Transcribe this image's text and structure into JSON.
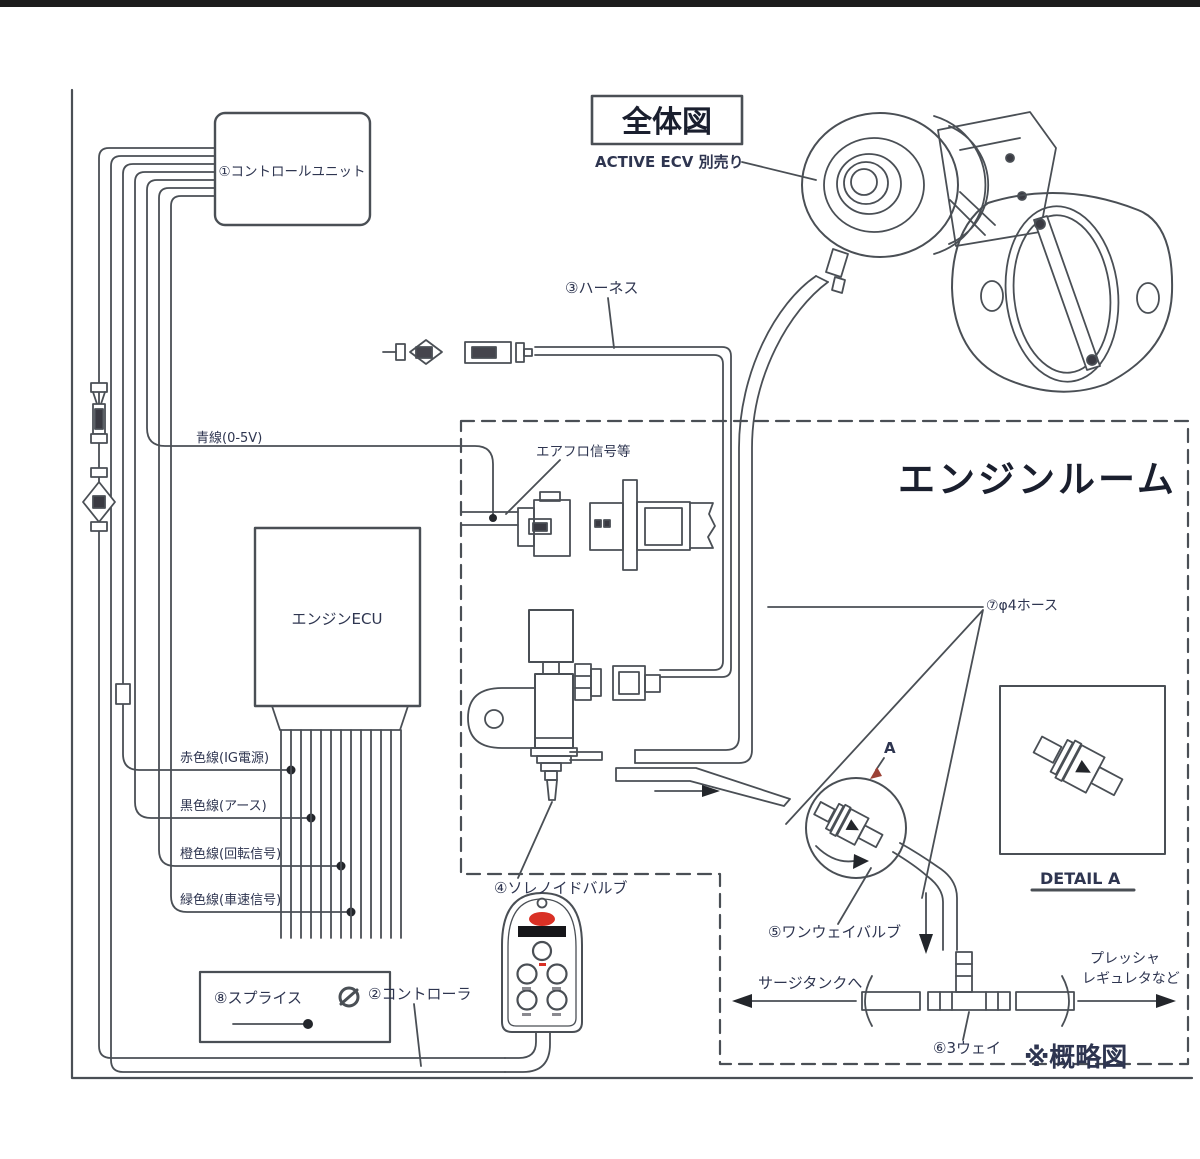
{
  "diagram": {
    "title": "全体図",
    "subtitle": "ACTIVE ECV 別売り",
    "area_label": "エンジンルーム",
    "schematic_note": "※概略図",
    "parts": {
      "control_unit": "①コントロールユニット",
      "controller": "②コントローラ",
      "harness": "③ハーネス",
      "solenoid_valve": "④ソレノイドバルブ",
      "one_way_valve": "⑤ワンウェイバルブ",
      "three_way": "⑥3ウェイ",
      "hose": "⑦φ4ホース",
      "splice": "⑧スプライス"
    },
    "wires": {
      "blue": "青線(0-5V)",
      "red": "赤色線(IG電源)",
      "black": "黒色線(アース)",
      "orange": "橙色線(回転信号)",
      "green": "緑色線(車速信号)"
    },
    "labels": {
      "airflow_signal": "エアフロ信号等",
      "engine_ecu": "エンジンECU",
      "surge_tank": "サージタンクへ",
      "pressure_reg_line1": "プレッシャ",
      "pressure_reg_line2": "レギュレタなど",
      "detail_a": "DETAIL A",
      "detail_a_marker": "A"
    }
  }
}
